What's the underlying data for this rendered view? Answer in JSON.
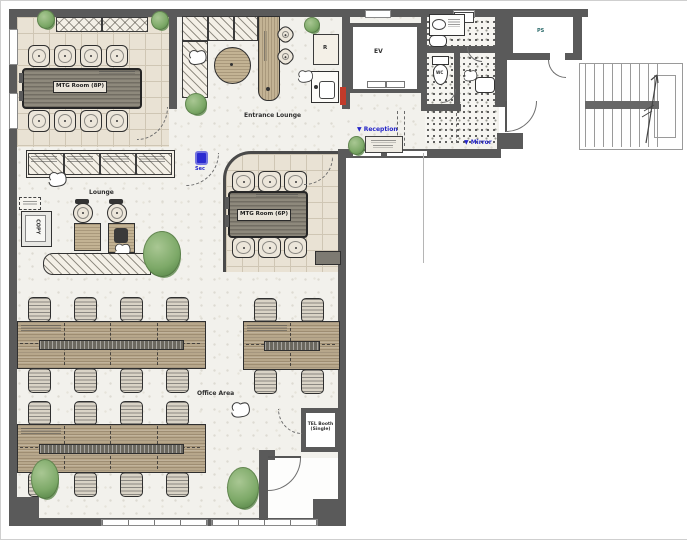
{
  "labels": {
    "mtg_room_8p": "MTG Room (8P)",
    "mtg_room_6p": "MTG Room (6P)",
    "entrance_lounge": "Entrance Lounge",
    "lounge": "Lounge",
    "office_area": "Office Area",
    "elevator": "EV",
    "pipe_shaft": "PS",
    "wc": "WC",
    "fridge": "R",
    "copy_machine": "COPY",
    "security": "Sec",
    "reception": "▼ Reception",
    "mirror": "▼ Mirror",
    "tel_booth_line1": "TEL Booth",
    "tel_booth_line2": "(Single)"
  },
  "colors": {
    "wall": "#5a5a5a",
    "annotation_blue": "#2424c8",
    "alarm_red": "#c23b2a",
    "wood_desk": "#b7a78b",
    "meeting_table": "#8e897c",
    "plant_green": "#7da968"
  }
}
